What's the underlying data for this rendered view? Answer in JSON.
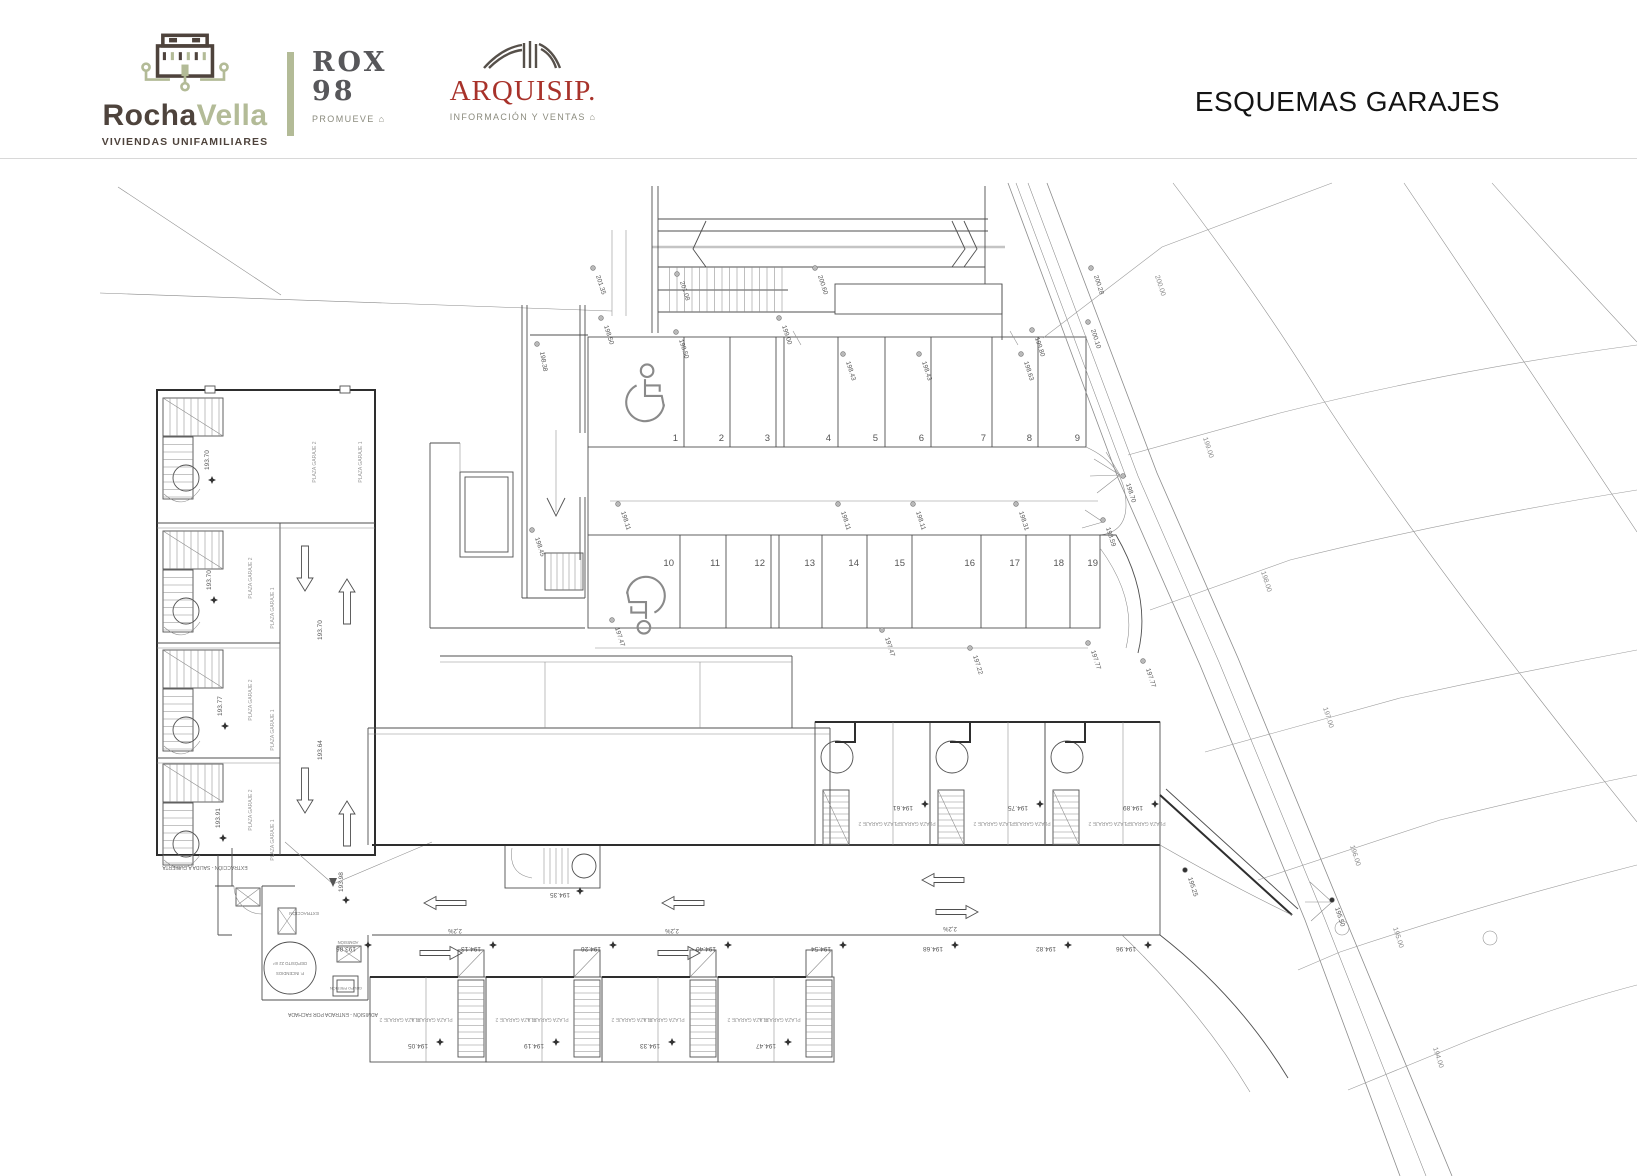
{
  "header": {
    "rocha": {
      "word1": "Rocha",
      "word2": "Vella",
      "tagline": "VIVIENDAS UNIFAMILIARES"
    },
    "rox": {
      "name": "ROX",
      "number": "98",
      "tagline": "PROMUEVE ⌂"
    },
    "arquisip": {
      "name": "ARQUISIP.",
      "tagline": "INFORMACIÓN Y VENTAS ⌂"
    },
    "title": "ESQUEMAS GARAJES",
    "colors": {
      "brown": "#4e433c",
      "sage": "#b3bb97",
      "rox_gray": "#57575a",
      "arq_red": "#a8322a",
      "muted": "#8b8b7e"
    }
  },
  "plan": {
    "labels": {
      "plaza1": "PLAZA GARAJE 1",
      "plaza2": "PLAZA GARAJE 2",
      "extr_note": "EXTRACCIÓN - SALIDA A CUBIERTA",
      "adm_note": "ADMISIÓN - ENTRADA POR FACHADA",
      "extraccion": "EXTRACCIÓN",
      "admision": "ADMISIÓN",
      "deposito": "DEPÓSITO 22 m³",
      "deposito2": "P. INCENDIOS",
      "grupo": "GRUPO PRESIÓN"
    },
    "parking_row_a": {
      "numbers": [
        "1",
        "2",
        "3",
        "4",
        "5",
        "6",
        "7",
        "8",
        "9"
      ],
      "accessible_space": "1"
    },
    "parking_row_b": {
      "numbers": [
        "10",
        "11",
        "12",
        "13",
        "14",
        "15",
        "16",
        "17",
        "18",
        "19"
      ],
      "accessible_space": "10"
    },
    "annotations": [
      {
        "t": "201.35",
        "x": 596,
        "y": 276,
        "r": 72,
        "m": "c",
        "mx": -3,
        "my": -8
      },
      {
        "t": "201.08",
        "x": 680,
        "y": 282,
        "r": 72,
        "m": "c",
        "mx": -3,
        "my": -8
      },
      {
        "t": "200.60",
        "x": 818,
        "y": 276,
        "r": 72,
        "m": "c",
        "mx": -3,
        "my": -8
      },
      {
        "t": "199.00",
        "x": 782,
        "y": 326,
        "r": 72,
        "m": "c",
        "mx": -3,
        "my": -8
      },
      {
        "t": "200.28",
        "x": 1094,
        "y": 276,
        "r": 72,
        "m": "c",
        "mx": -3,
        "my": -8
      },
      {
        "t": "200.10",
        "x": 1091,
        "y": 330,
        "r": 72,
        "m": "c",
        "mx": -3,
        "my": -8
      },
      {
        "t": "199.80",
        "x": 1035,
        "y": 338,
        "r": 72,
        "m": "c",
        "mx": -3,
        "my": -8
      },
      {
        "t": "198.50",
        "x": 604,
        "y": 326,
        "r": 72,
        "m": "c",
        "mx": -3,
        "my": -8
      },
      {
        "t": "198.50",
        "x": 679,
        "y": 340,
        "r": 72,
        "m": "c",
        "mx": -3,
        "my": -8
      },
      {
        "t": "198.38",
        "x": 540,
        "y": 352,
        "r": 80,
        "m": "c",
        "mx": -3,
        "my": -8
      },
      {
        "t": "198.43",
        "x": 846,
        "y": 362,
        "r": 72,
        "m": "c",
        "mx": -3,
        "my": -8
      },
      {
        "t": "198.43",
        "x": 922,
        "y": 362,
        "r": 72,
        "m": "c",
        "mx": -3,
        "my": -8
      },
      {
        "t": "198.63",
        "x": 1024,
        "y": 362,
        "r": 72,
        "m": "c",
        "mx": -3,
        "my": -8
      },
      {
        "t": "198.45",
        "x": 535,
        "y": 538,
        "r": 72,
        "m": "c",
        "mx": -3,
        "my": -8
      },
      {
        "t": "198.11",
        "x": 621,
        "y": 512,
        "r": 72,
        "m": "c",
        "mx": -3,
        "my": -8
      },
      {
        "t": "198.11",
        "x": 841,
        "y": 512,
        "r": 72,
        "m": "c",
        "mx": -3,
        "my": -8
      },
      {
        "t": "198.11",
        "x": 916,
        "y": 512,
        "r": 72,
        "m": "c",
        "mx": -3,
        "my": -8
      },
      {
        "t": "198.31",
        "x": 1019,
        "y": 512,
        "r": 72,
        "m": "c",
        "mx": -3,
        "my": -8
      },
      {
        "t": "198.70",
        "x": 1126,
        "y": 484,
        "r": 72,
        "m": "c",
        "mx": -3,
        "my": -8
      },
      {
        "t": "198.59",
        "x": 1106,
        "y": 528,
        "r": 72,
        "m": "c",
        "mx": -3,
        "my": -8
      },
      {
        "t": "197.77",
        "x": 1091,
        "y": 651,
        "r": 72,
        "m": "c",
        "mx": -3,
        "my": -8
      },
      {
        "t": "197.77",
        "x": 1146,
        "y": 669,
        "r": 72,
        "m": "c",
        "mx": -3,
        "my": -8
      },
      {
        "t": "197.47",
        "x": 615,
        "y": 628,
        "r": 72,
        "m": "c",
        "mx": -3,
        "my": -8
      },
      {
        "t": "197.47",
        "x": 885,
        "y": 638,
        "r": 72,
        "m": "c",
        "mx": -3,
        "my": -8
      },
      {
        "t": "197.22",
        "x": 973,
        "y": 656,
        "r": 72,
        "m": "c",
        "mx": -3,
        "my": -8
      },
      {
        "t": "195.50",
        "x": 1335,
        "y": 908,
        "r": 72,
        "m": "b",
        "mx": -3,
        "my": -8
      },
      {
        "t": "195.25",
        "x": 1188,
        "y": 878,
        "r": 72,
        "m": "b",
        "mx": -3,
        "my": -8
      },
      {
        "t": "200.00",
        "x": 1155,
        "y": 276,
        "r": 72,
        "s": 7,
        "c": "#8a8a8a"
      },
      {
        "t": "199.00",
        "x": 1203,
        "y": 438,
        "r": 72,
        "s": 7,
        "c": "#8a8a8a"
      },
      {
        "t": "198.00",
        "x": 1261,
        "y": 572,
        "r": 72,
        "s": 7,
        "c": "#8a8a8a"
      },
      {
        "t": "197.00",
        "x": 1323,
        "y": 708,
        "r": 72,
        "s": 7,
        "c": "#8a8a8a"
      },
      {
        "t": "196.00",
        "x": 1350,
        "y": 846,
        "r": 72,
        "s": 7,
        "c": "#8a8a8a"
      },
      {
        "t": "195.00",
        "x": 1393,
        "y": 928,
        "r": 72,
        "s": 7,
        "c": "#8a8a8a"
      },
      {
        "t": "194.00",
        "x": 1433,
        "y": 1048,
        "r": 72,
        "s": 7,
        "c": "#8a8a8a"
      },
      {
        "t": "193.70",
        "x": 322,
        "y": 640,
        "r": -90
      },
      {
        "t": "193.64",
        "x": 322,
        "y": 760,
        "r": -90
      },
      {
        "t": "193.98",
        "x": 343,
        "y": 892,
        "r": -90,
        "m": "d",
        "mx": 3,
        "my": 8
      },
      {
        "t": "193.70",
        "x": 209,
        "y": 470,
        "r": -90,
        "m": "d",
        "mx": 3,
        "my": 10
      },
      {
        "t": "193.70",
        "x": 211,
        "y": 590,
        "r": -90,
        "m": "d",
        "mx": 3,
        "my": 10
      },
      {
        "t": "193.77",
        "x": 222,
        "y": 716,
        "r": -90,
        "m": "d",
        "mx": 3,
        "my": 10
      },
      {
        "t": "193.91",
        "x": 220,
        "y": 828,
        "r": -90,
        "m": "d",
        "mx": 3,
        "my": 10
      },
      {
        "t": "193.86",
        "x": 346,
        "y": 947,
        "r": 180,
        "a": "m",
        "m": "d",
        "mx": 22,
        "my": -2
      },
      {
        "t": "194.13",
        "x": 471,
        "y": 947,
        "r": 180,
        "a": "m",
        "m": "d",
        "mx": 22,
        "my": -2
      },
      {
        "t": "194.26",
        "x": 591,
        "y": 947,
        "r": 180,
        "a": "m",
        "m": "d",
        "mx": 22,
        "my": -2
      },
      {
        "t": "194.40",
        "x": 706,
        "y": 947,
        "r": 180,
        "a": "m",
        "m": "d",
        "mx": 22,
        "my": -2
      },
      {
        "t": "194.54",
        "x": 821,
        "y": 947,
        "r": 180,
        "a": "m",
        "m": "d",
        "mx": 22,
        "my": -2
      },
      {
        "t": "194.68",
        "x": 933,
        "y": 947,
        "r": 180,
        "a": "m",
        "m": "d",
        "mx": 22,
        "my": -2
      },
      {
        "t": "194.82",
        "x": 1046,
        "y": 947,
        "r": 180,
        "a": "m",
        "m": "d",
        "mx": 22,
        "my": -2
      },
      {
        "t": "194.96",
        "x": 1126,
        "y": 947,
        "r": 180,
        "a": "m",
        "m": "d",
        "mx": 22,
        "my": -2
      },
      {
        "t": "2,2%",
        "x": 455,
        "y": 929,
        "r": 180,
        "a": "m",
        "s": 6
      },
      {
        "t": "2,2%",
        "x": 672,
        "y": 929,
        "r": 180,
        "a": "m",
        "s": 6
      },
      {
        "t": "2,2%",
        "x": 950,
        "y": 927,
        "r": 180,
        "a": "m",
        "s": 6
      },
      {
        "t": "194.35",
        "x": 560,
        "y": 893,
        "r": 180,
        "a": "m",
        "m": "d",
        "mx": 20,
        "my": -2
      },
      {
        "t": "194.05",
        "x": 418,
        "y": 1044,
        "r": 180,
        "a": "m",
        "m": "d",
        "mx": 22,
        "my": -2
      },
      {
        "t": "194.19",
        "x": 534,
        "y": 1044,
        "r": 180,
        "a": "m",
        "m": "d",
        "mx": 22,
        "my": -2
      },
      {
        "t": "194.33",
        "x": 650,
        "y": 1044,
        "r": 180,
        "a": "m",
        "m": "d",
        "mx": 22,
        "my": -2
      },
      {
        "t": "194.47",
        "x": 766,
        "y": 1044,
        "r": 180,
        "a": "m",
        "m": "d",
        "mx": 22,
        "my": -2
      },
      {
        "t": "194.61",
        "x": 903,
        "y": 806,
        "r": 180,
        "a": "m",
        "m": "d",
        "mx": 22,
        "my": -2
      },
      {
        "t": "194.75",
        "x": 1018,
        "y": 806,
        "r": 180,
        "a": "m",
        "m": "d",
        "mx": 22,
        "my": -2
      },
      {
        "t": "194.89",
        "x": 1133,
        "y": 806,
        "r": 180,
        "a": "m",
        "m": "d",
        "mx": 22,
        "my": -2
      },
      {
        "t": "EXTRACCIÓN",
        "x": 304,
        "y": 912,
        "r": 180,
        "a": "m",
        "s": 4.5,
        "c": "#777777"
      },
      {
        "t": "ADMISIÓN",
        "x": 348,
        "y": 941,
        "r": 180,
        "a": "m",
        "s": 4.2,
        "c": "#777777"
      },
      {
        "t": "DEPÓSITO 22 m³",
        "x": 290,
        "y": 962,
        "r": 180,
        "a": "m",
        "s": 4.2,
        "c": "#777777"
      },
      {
        "t": "P. INCENDIOS",
        "x": 290,
        "y": 972,
        "r": 180,
        "a": "m",
        "s": 4.2,
        "c": "#777777"
      },
      {
        "t": "GRUPO PRESIÓN",
        "x": 346,
        "y": 987,
        "r": 180,
        "a": "m",
        "s": 3.8,
        "c": "#777777"
      },
      {
        "t": "EXTRACCIÓN - SALIDA A CUBIERTA",
        "x": 205,
        "y": 866,
        "r": 180,
        "a": "m",
        "s": 5,
        "c": "#666666"
      },
      {
        "t": "ADMISIÓN - ENTRADA POR FACHADA",
        "x": 333,
        "y": 1013,
        "r": 180,
        "a": "m",
        "s": 5,
        "c": "#666666"
      }
    ]
  }
}
